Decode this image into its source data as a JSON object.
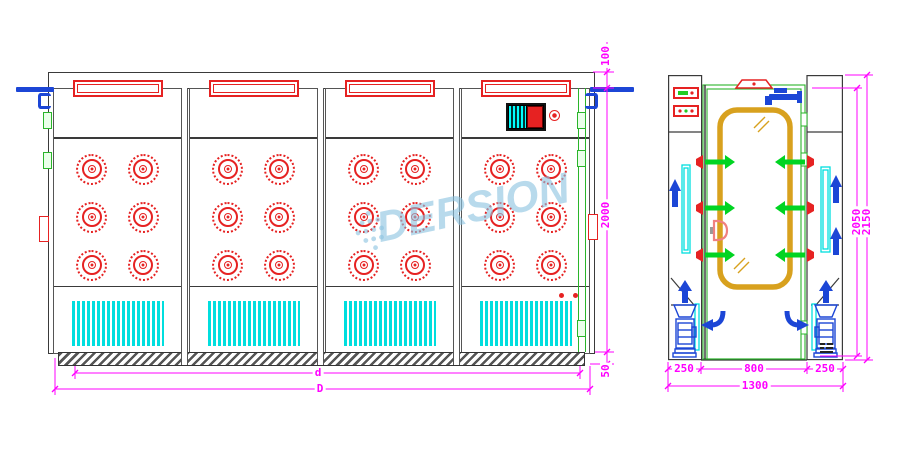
{
  "watermark": {
    "text": "DERSION"
  },
  "front_view": {
    "panels": [
      {
        "id": "panel-1",
        "nozzle_rows": 3,
        "nozzle_cols": 2
      },
      {
        "id": "panel-2",
        "nozzle_rows": 3,
        "nozzle_cols": 2
      },
      {
        "id": "panel-3",
        "nozzle_rows": 3,
        "nozzle_cols": 2
      },
      {
        "id": "panel-4",
        "nozzle_rows": 3,
        "nozzle_cols": 2,
        "has_control_panel": true,
        "indicator_dots": 2
      }
    ],
    "dimensions": {
      "top_height": "100",
      "body_height": "2000",
      "base_height": "50",
      "inner_width": "d",
      "outer_width": "D"
    }
  },
  "side_view": {
    "dimensions": {
      "left_section": "250",
      "chamber_width": "800",
      "right_section": "250",
      "total_width": "1300",
      "inner_height": "2050",
      "total_height": "2150"
    }
  },
  "colors": {
    "dimension": "#FF00FF",
    "outline": "#3A3A3A",
    "nozzle_red": "#E62222",
    "airflow_green": "#00D422",
    "airflow_blue": "#1C46D6",
    "grille_cyan": "#00DEDE",
    "door_frame_gold": "#D8A11E",
    "watermark_blue": "#8CC3E1"
  }
}
